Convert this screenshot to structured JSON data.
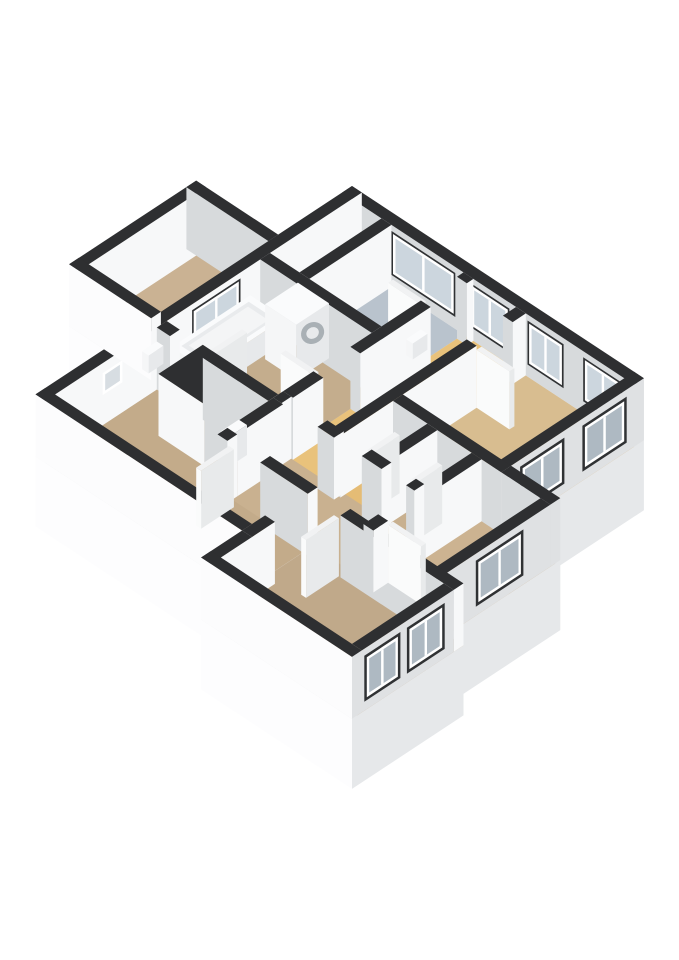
{
  "canvas": {
    "width": 679,
    "height": 960,
    "background": "#ffffff"
  },
  "iso": {
    "origin_x": 352,
    "origin_y": 248,
    "ax": 0.82,
    "ay": 0.54,
    "wall_height": 62,
    "plinth_depth": 70
  },
  "palette": {
    "wall_top": "#2e2f31",
    "int_white": "#f7f8f9",
    "int_gray": "#d7dadc",
    "ext_white": "#fcfcfd",
    "ext_gray": "#dfe1e3",
    "skirt_x": "#e6e8ea",
    "skirt_y": "#fdfdfe",
    "slab_top": "#e9eaeb",
    "frame": "#ffffff",
    "glass_in": "#ccd6de",
    "glass_out": "#aeb9c2",
    "glass_vent": "#d7dde2",
    "reveal": "#303234",
    "door_top": "#f1f2f3",
    "door_x": "#e8eaeb",
    "door_y": "#fafbfb",
    "obj_top": "#fafbfc",
    "obj_x": "#e7e9eb",
    "obj_y": "#f5f6f7",
    "basin": "#e9ebed",
    "basin_inner": "#f4f5f6",
    "washer_ring": "#a9b0b5",
    "washer_core": "#e8eaec",
    "floor_dark": "#3c3e41",
    "floor_blue": "#b9c3cd",
    "floor_orange": "#e9c27b",
    "floor_tan": "#c4ad8d"
  },
  "slab": {
    "outline": [
      [
        0,
        0
      ],
      [
        356,
        0
      ],
      [
        356,
        162
      ],
      [
        416,
        162
      ],
      [
        416,
        300
      ],
      [
        436,
        300
      ],
      [
        436,
        436
      ],
      [
        252,
        436
      ],
      [
        252,
        386
      ],
      [
        0,
        386
      ],
      [
        0,
        245
      ],
      [
        -100,
        245
      ],
      [
        -100,
        90
      ],
      [
        0,
        90
      ]
    ],
    "skirts": [
      {
        "name": "skirt-bedroom-tl-sw",
        "face": "y",
        "c": 245,
        "a1": -100,
        "a2": 0
      },
      {
        "name": "skirt-east-bedroom",
        "face": "x",
        "c": 356,
        "a1": 0,
        "a2": 162
      },
      {
        "name": "skirt-south-main",
        "face": "y",
        "c": 386,
        "a1": 0,
        "a2": 252
      },
      {
        "name": "skirt-east-storage",
        "face": "x",
        "c": 416,
        "a1": 162,
        "a2": 300
      },
      {
        "name": "skirt-south-bottom",
        "face": "y",
        "c": 436,
        "a1": 252,
        "a2": 436
      },
      {
        "name": "skirt-east-bottom",
        "face": "x",
        "c": 436,
        "a1": 300,
        "a2": 436
      }
    ]
  },
  "rooms": [
    {
      "name": "shaft",
      "color": "#3c3e41",
      "poly": [
        [
          12,
          12
        ],
        [
          48,
          12
        ],
        [
          48,
          112
        ],
        [
          12,
          112
        ]
      ]
    },
    {
      "name": "bathroom-blue",
      "color": "#b9c3cd",
      "poly": [
        [
          48,
          12
        ],
        [
          148,
          12
        ],
        [
          148,
          112
        ],
        [
          48,
          112
        ]
      ]
    },
    {
      "name": "hallway",
      "color": "#e9c27b",
      "poly": [
        [
          148,
          12
        ],
        [
          212,
          12
        ],
        [
          212,
          238
        ],
        [
          148,
          238
        ]
      ]
    },
    {
      "name": "bedroom-right",
      "color": "#d8bd90",
      "poly": [
        [
          212,
          12
        ],
        [
          356,
          12
        ],
        [
          356,
          168
        ],
        [
          212,
          168
        ]
      ]
    },
    {
      "name": "bathroom",
      "color": "#c4ad8d",
      "poly": [
        [
          12,
          112
        ],
        [
          148,
          112
        ],
        [
          148,
          244
        ],
        [
          12,
          244
        ]
      ]
    },
    {
      "name": "toilet",
      "color": "#e5bc75",
      "poly": [
        [
          212,
          162
        ],
        [
          266,
          162
        ],
        [
          266,
          238
        ],
        [
          212,
          238
        ]
      ]
    },
    {
      "name": "storage-a",
      "color": "#c8b08f",
      "poly": [
        [
          266,
          162
        ],
        [
          320,
          162
        ],
        [
          320,
          238
        ],
        [
          266,
          238
        ]
      ]
    },
    {
      "name": "storage-b",
      "color": "#ccb391",
      "poly": [
        [
          320,
          168
        ],
        [
          416,
          168
        ],
        [
          416,
          306
        ],
        [
          320,
          306
        ]
      ]
    },
    {
      "name": "corridor-south",
      "color": "#c9b190",
      "poly": [
        [
          148,
          232
        ],
        [
          320,
          232
        ],
        [
          320,
          312
        ],
        [
          148,
          312
        ]
      ]
    },
    {
      "name": "bedroom-top-left",
      "color": "#cab293",
      "poly": [
        [
          -90,
          100
        ],
        [
          0,
          100
        ],
        [
          0,
          235
        ],
        [
          -90,
          235
        ]
      ]
    },
    {
      "name": "living-room",
      "color": "#c3ab8a",
      "poly": [
        [
          12,
          244
        ],
        [
          148,
          244
        ],
        [
          148,
          306
        ],
        [
          252,
          306
        ],
        [
          252,
          380
        ],
        [
          12,
          380
        ]
      ]
    },
    {
      "name": "bedroom-bottom",
      "color": "#c0a98a",
      "poly": [
        [
          252,
          300
        ],
        [
          436,
          300
        ],
        [
          436,
          430
        ],
        [
          252,
          430
        ]
      ]
    }
  ],
  "walls": [
    {
      "name": "bedroom-tl-wall-nw",
      "box": [
        -100,
        90,
        -88,
        245
      ],
      "cx": "int_white",
      "cy": "ext_white"
    },
    {
      "name": "bedroom-tl-wall-ne",
      "box": [
        -100,
        90,
        0,
        102
      ],
      "cx": "int_white",
      "cy": "int_gray"
    },
    {
      "name": "bedroom-tl-wall-sw",
      "box": [
        -100,
        233,
        0,
        245
      ],
      "cx": "int_white",
      "cy": "ext_white"
    },
    {
      "name": "wall-north",
      "box": [
        0,
        0,
        356,
        12
      ],
      "cx": "ext_gray",
      "cy": "int_gray",
      "windows": [
        {
          "face": "y",
          "a1": 62,
          "a2": 136,
          "z1": 14,
          "z2": 54,
          "style": "in"
        },
        {
          "face": "y",
          "a1": 158,
          "a2": 202,
          "z1": 14,
          "z2": 54,
          "style": "in"
        },
        {
          "face": "y",
          "a1": 228,
          "a2": 268,
          "z1": 14,
          "z2": 54,
          "style": "in"
        },
        {
          "face": "y",
          "a1": 296,
          "a2": 340,
          "z1": 14,
          "z2": 54,
          "style": "in"
        }
      ]
    },
    {
      "name": "wall-west",
      "box": [
        0,
        0,
        12,
        386
      ],
      "cx": "int_white",
      "cy": "ext_white",
      "windows": [
        {
          "face": "x",
          "a1": 150,
          "a2": 205,
          "z1": 14,
          "z2": 54,
          "style": "in"
        },
        {
          "face": "x",
          "a1": 292,
          "a2": 316,
          "z1": 30,
          "z2": 52,
          "style": "vent"
        }
      ]
    },
    {
      "name": "wall-east-bedroom",
      "box": [
        344,
        0,
        356,
        174
      ],
      "cx": "ext_gray",
      "cy": "int_white",
      "windows": [
        {
          "face": "x",
          "a1": 24,
          "a2": 72,
          "z1": 12,
          "z2": 52,
          "style": "out"
        },
        {
          "face": "x",
          "a1": 100,
          "a2": 148,
          "z1": 12,
          "z2": 52,
          "style": "out"
        }
      ]
    },
    {
      "name": "wall-step-north",
      "box": [
        356,
        162,
        416,
        174
      ],
      "cx": "ext_gray",
      "cy": "int_gray"
    },
    {
      "name": "wall-east-storage",
      "box": [
        404,
        174,
        416,
        312
      ],
      "cx": "ext_gray",
      "cy": "int_white",
      "windows": [
        {
          "face": "x",
          "a1": 210,
          "a2": 262,
          "z1": 12,
          "z2": 52,
          "style": "out"
        }
      ]
    },
    {
      "name": "wall-east-bottom",
      "box": [
        424,
        312,
        436,
        424
      ],
      "k": 660,
      "cx": "ext_gray",
      "cy": "int_white",
      "windows": [
        {
          "face": "x",
          "a1": 326,
          "a2": 366,
          "z1": 12,
          "z2": 52,
          "style": "out"
        },
        {
          "face": "x",
          "a1": 380,
          "a2": 418,
          "z1": 12,
          "z2": 52,
          "style": "out"
        }
      ]
    },
    {
      "name": "wall-south-bottom",
      "box": [
        252,
        424,
        436,
        436
      ],
      "cx": "ext_gray",
      "cy": "ext_white"
    },
    {
      "name": "wall-west-bottom",
      "box": [
        252,
        386,
        264,
        436
      ],
      "cx": "int_white",
      "cy": "ext_white"
    },
    {
      "name": "wall-south-main",
      "box": [
        0,
        374,
        252,
        386
      ],
      "cx": "int_white",
      "cy": "ext_white"
    },
    {
      "name": "wall-shaft-east",
      "box": [
        48,
        12,
        60,
        112
      ],
      "cx": "int_white",
      "cy": "int_gray"
    },
    {
      "name": "wall-hall-west-1",
      "box": [
        148,
        12,
        160,
        20
      ],
      "cx": "int_white",
      "cy": "int_gray"
    },
    {
      "name": "wall-hall-west-2",
      "box": [
        148,
        64,
        160,
        150
      ],
      "cx": "int_white",
      "cy": "int_gray"
    },
    {
      "name": "wall-hall-west-3",
      "box": [
        148,
        195,
        160,
        232
      ],
      "cx": "int_white",
      "cy": "int_gray"
    },
    {
      "name": "wall-bath-north",
      "box": [
        12,
        112,
        148,
        124
      ],
      "cx": "int_white",
      "cy": "int_gray"
    },
    {
      "name": "wall-bath-south-1",
      "box": [
        12,
        238,
        28,
        250
      ],
      "cx": "int_white",
      "cy": "int_gray"
    },
    {
      "name": "wall-bath-south-2",
      "box": [
        68,
        238,
        148,
        250
      ],
      "cx": "int_white",
      "cy": "int_gray"
    },
    {
      "name": "wall-hall-east-1",
      "box": [
        212,
        12,
        224,
        28
      ],
      "cx": "int_white",
      "cy": "int_gray"
    },
    {
      "name": "wall-hall-east-2",
      "box": [
        212,
        72,
        224,
        238
      ],
      "cx": "int_white",
      "cy": "int_gray"
    },
    {
      "name": "wall-cluster-north",
      "box": [
        224,
        162,
        356,
        174
      ],
      "cx": "int_white",
      "cy": "int_gray"
    },
    {
      "name": "wall-toilet-east",
      "box": [
        266,
        174,
        278,
        232
      ],
      "cx": "int_white",
      "cy": "int_gray"
    },
    {
      "name": "wall-storage-west-1",
      "box": [
        320,
        174,
        332,
        248
      ],
      "cx": "int_white",
      "cy": "int_gray"
    },
    {
      "name": "wall-storage-west-2",
      "box": [
        320,
        288,
        332,
        306
      ],
      "cx": "int_white",
      "cy": "int_gray"
    },
    {
      "name": "wall-corridor-north-1",
      "box": [
        148,
        232,
        158,
        244
      ],
      "cx": "int_white",
      "cy": "int_gray"
    },
    {
      "name": "wall-corridor-north-2",
      "box": [
        202,
        232,
        222,
        244
      ],
      "cx": "int_white",
      "cy": "int_gray"
    },
    {
      "name": "wall-corridor-north-3",
      "box": [
        256,
        232,
        280,
        244
      ],
      "cx": "int_white",
      "cy": "int_gray"
    },
    {
      "name": "wall-corridor-north-4",
      "box": [
        310,
        232,
        320,
        244
      ],
      "cx": "int_white",
      "cy": "int_gray"
    },
    {
      "name": "wall-corridor-south-1",
      "box": [
        148,
        300,
        160,
        312
      ],
      "cx": "int_white",
      "cy": "int_gray"
    },
    {
      "name": "wall-corridor-south-2",
      "box": [
        200,
        300,
        258,
        312
      ],
      "cx": "int_white",
      "cy": "int_gray"
    },
    {
      "name": "wall-corridor-south-3",
      "box": [
        298,
        300,
        436,
        312
      ],
      "cx": "int_white",
      "cy": "int_gray"
    },
    {
      "name": "wall-corridor-west",
      "box": [
        148,
        244,
        160,
        300
      ],
      "cx": "int_white",
      "cy": "int_gray"
    },
    {
      "name": "wall-living-east",
      "box": [
        252,
        358,
        264,
        386
      ],
      "cx": "int_white",
      "cy": "int_gray"
    },
    {
      "name": "closet-block",
      "box": [
        56,
        238,
        112,
        292
      ],
      "cx": "int_gray",
      "cy": "int_white"
    }
  ],
  "objects": [
    {
      "name": "bathtub",
      "box": [
        4,
        128,
        46,
        224
      ],
      "z": [
        0,
        24
      ],
      "top": "obj_top",
      "cx": "obj_x",
      "cy": "obj_y",
      "decor": "tub"
    },
    {
      "name": "washing-machine",
      "box": [
        50,
        116,
        88,
        156
      ],
      "z": [
        0,
        55
      ],
      "top": "obj_top",
      "cx": "obj_x",
      "cy": "obj_y",
      "decor": "washer"
    },
    {
      "name": "vent-box",
      "box": [
        12,
        250,
        20,
        268
      ],
      "z": [
        30,
        48
      ],
      "top": "obj_top",
      "cx": "obj_x",
      "cy": "obj_y"
    },
    {
      "name": "meter-box",
      "box": [
        138,
        276,
        148,
        298
      ],
      "z": [
        22,
        52
      ],
      "top": "obj_top",
      "cx": "obj_x",
      "cy": "obj_y"
    },
    {
      "name": "doorbell-box",
      "box": [
        160,
        76,
        168,
        94
      ],
      "z": [
        30,
        46
      ],
      "top": "obj_top",
      "cx": "obj_x",
      "cy": "obj_y"
    }
  ],
  "doors": [
    {
      "name": "bathroom-door",
      "box": [
        62,
        196,
        68,
        238
      ]
    },
    {
      "name": "living-room-door",
      "box": [
        162,
        312,
        168,
        352
      ]
    },
    {
      "name": "bottom-room-door",
      "box": [
        290,
        312,
        296,
        352
      ]
    },
    {
      "name": "toilet-door",
      "box": [
        250,
        198,
        256,
        232
      ]
    },
    {
      "name": "bedroom-right-door",
      "box": [
        224,
        66,
        264,
        72
      ]
    },
    {
      "name": "storage-a-door",
      "box": [
        304,
        200,
        310,
        232
      ]
    },
    {
      "name": "storage-b-door",
      "box": [
        332,
        282,
        372,
        288
      ]
    },
    {
      "name": "bathroom-blue-door",
      "box": [
        108,
        58,
        148,
        64
      ]
    },
    {
      "name": "bathroom-hall-door",
      "box": [
        108,
        189,
        148,
        195
      ]
    }
  ]
}
